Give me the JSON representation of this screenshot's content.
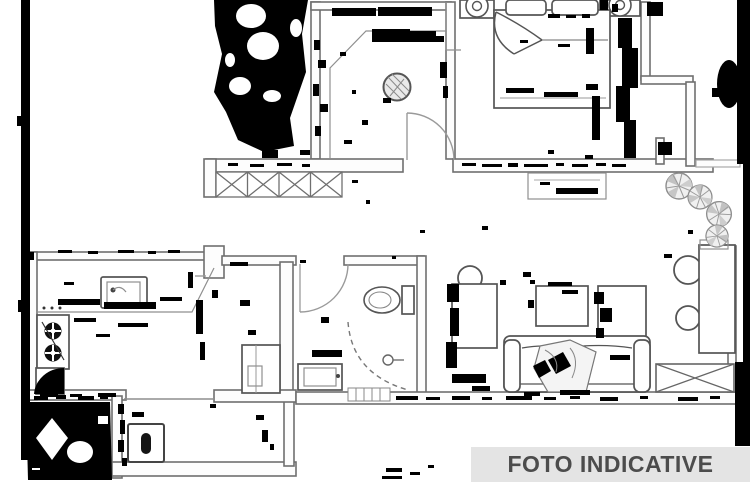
{
  "banner": {
    "label": "FOTO INDICATIVE"
  },
  "colors": {
    "paper": "#ffffff",
    "wall": "#6f6f6f",
    "furniture": "#555555",
    "ink": "#000000",
    "banner_bg": "#e4e4e4",
    "banner_text": "#4c4c4c"
  },
  "drawing": {
    "kind": "scanned apartment floor plan with heavy toner noise",
    "elements": [
      "double-bed",
      "pillows",
      "nightstand-lamp",
      "nightstand-lamp",
      "hatched-wardrobe",
      "round-hatched-table",
      "entry-door-arc",
      "kitchen-stove",
      "kitchen-sink",
      "corner-cabinet",
      "tall-cabinet",
      "toilet",
      "shower-tray",
      "wash-basin",
      "bathroom-door-arc",
      "desk",
      "desk-chair",
      "sofa-with-blanket",
      "coffee-table",
      "side-cabinet",
      "dining-table",
      "round-chair",
      "round-chair",
      "hatched-window-sill",
      "balcony-plants",
      "washing-machine"
    ]
  }
}
